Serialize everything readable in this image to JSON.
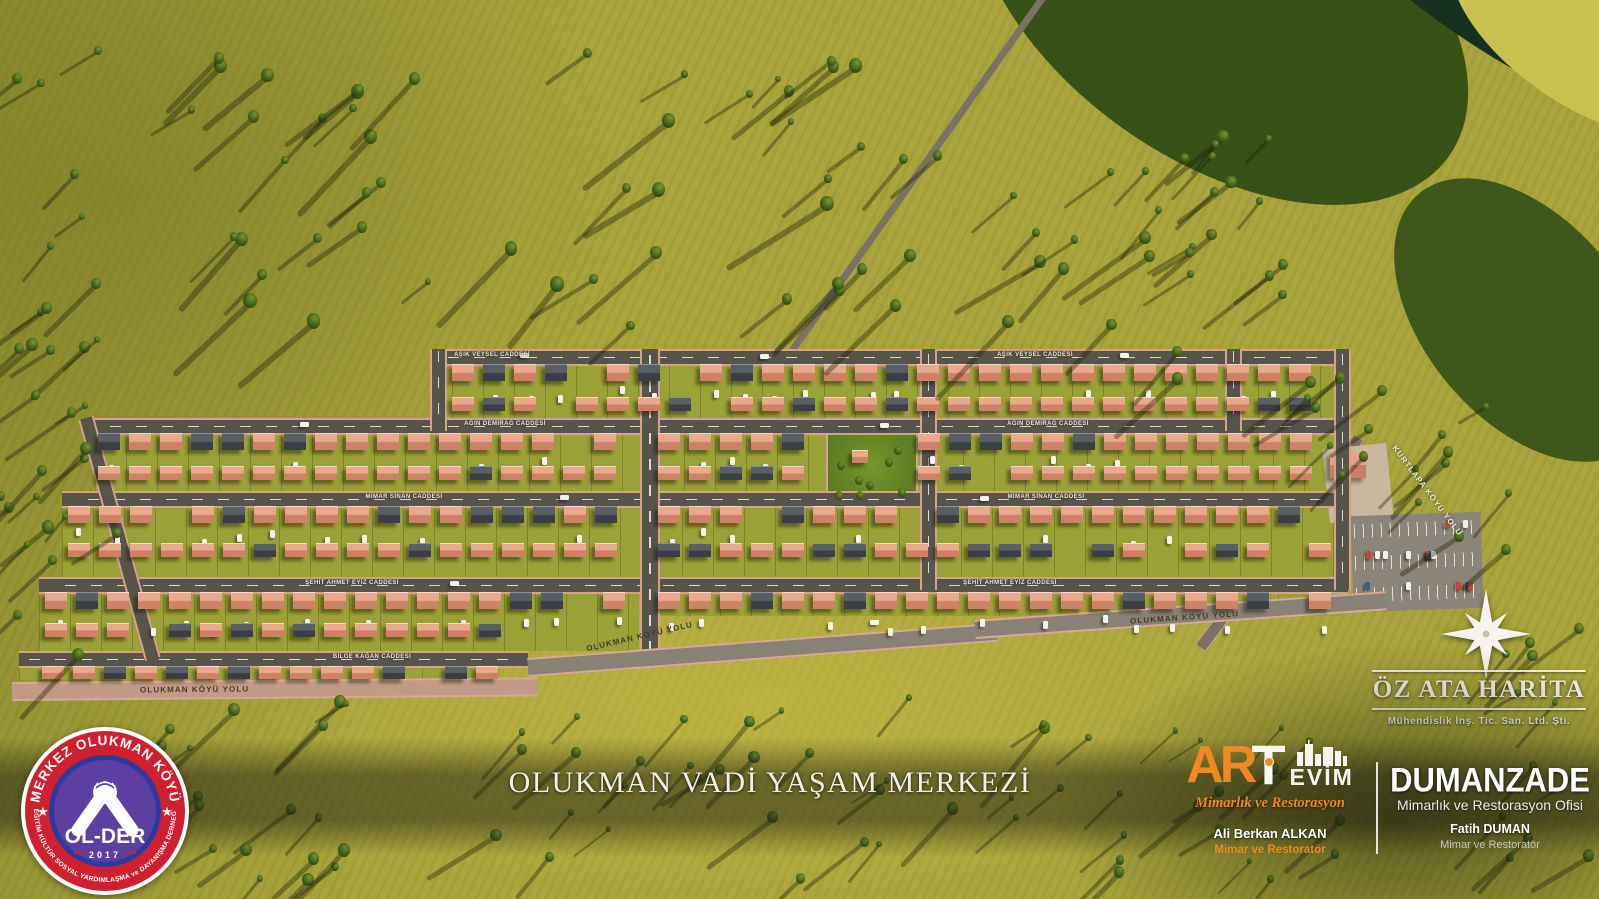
{
  "title": "OLUKMAN VADİ YAŞAM MERKEZİ",
  "older_badge": {
    "arc_top": "MERKEZ OLUKMAN KÖYÜ",
    "arc_bottom": "EĞİTİM KÜLTÜR SOSYAL YARDIMLAŞMA ve DAYANIŞMA DERNEĞİ",
    "star_left": "★",
    "star_right": "★",
    "name": "OL-DER",
    "year": "2017"
  },
  "artevim": {
    "brand_prefix": "AR",
    "brand_t": "T",
    "brand_suffix": "EVİM",
    "tagline": "Mimarlık ve Restorasyon",
    "person": "Ali Berkan ALKAN",
    "person_title": "Mimar ve Restoratör"
  },
  "dumanzade": {
    "brand": "DUMANZADE",
    "tagline": "Mimarlık ve Restorasyon Ofisi",
    "person": "Fatih DUMAN",
    "person_title": "Mimar ve Restoratör"
  },
  "ozata": {
    "brand": "ÖZ ATA HARİTA",
    "tagline": "Mühendislik İnş. Tic. San. Ltd. Şti."
  },
  "roads": {
    "perimeter_left": "OLUKMAN KÖYÜ YOLU",
    "perimeter_center": "OLUKMAN KÖYÜ YOLU",
    "perimeter_right": "OLUKMAN KÖYÜ YOLU",
    "kurtlapa": "KURTLAPA KÖYÜ YOLU"
  },
  "streets": {
    "row1_left": "AŞIK VEYSEL CADDESİ",
    "row1_right": "AŞIK VEYSEL CADDESİ",
    "row2_left": "AĞIN DEMİRAĞ CADDESİ",
    "row2_right": "AĞIN DEMİRAĞ CADDESİ",
    "row3_left": "MİMAR SİNAN CADDESİ",
    "row3_right": "MİMAR SİNAN CADDESİ",
    "row4_left": "ŞEHİT AHMET EYİZ CADDESİ",
    "row4_right": "ŞEHİT AHMET EYİZ CADDESİ",
    "row5_left": "BİLGE KAĞAN CADDESİ"
  },
  "colors": {
    "accent_orange": "#ef8722",
    "badge_red": "#cf2030",
    "badge_purple": "#5c3fa0",
    "badge_blue": "#2b3a9e",
    "roof_salmon": "#d48a70",
    "roof_dark": "#43464a",
    "grass": "#a9a43c"
  }
}
